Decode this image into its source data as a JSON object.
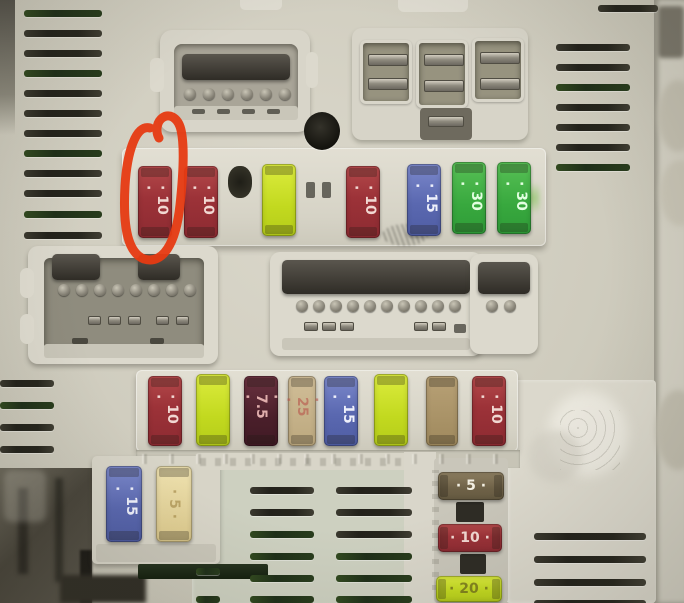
{
  "image": {
    "type": "photograph",
    "subject": "Car engine-bay fuse box (body control module) with mini blade fuses, multi-pin connectors and vent slots",
    "annotation": {
      "kind": "hand-drawn red loop",
      "color": "#e63a12",
      "highlights": "left-most red 10A mini fuse in the upper fuse row"
    }
  },
  "fuses": {
    "top_row": [
      {
        "amps": "10",
        "color": "red",
        "circled": true
      },
      {
        "amps": "10",
        "color": "red"
      },
      {
        "amps": "",
        "color": "yellow-green"
      },
      {
        "amps": "10",
        "color": "red"
      },
      {
        "amps": "15",
        "color": "blue"
      },
      {
        "amps": "30",
        "color": "green"
      },
      {
        "amps": "30",
        "color": "green"
      }
    ],
    "middle_row": [
      {
        "amps": "10",
        "color": "red"
      },
      {
        "amps": "",
        "color": "yellow-green"
      },
      {
        "amps": "7.5",
        "color": "maroon-brown"
      },
      {
        "amps": "25",
        "color": "tan"
      },
      {
        "amps": "15",
        "color": "blue"
      },
      {
        "amps": "",
        "color": "yellow-green"
      },
      {
        "amps": "",
        "color": "tan-brown"
      },
      {
        "amps": "10",
        "color": "red"
      }
    ],
    "bottom_left_pair": [
      {
        "amps": "15",
        "color": "blue"
      },
      {
        "amps": "5",
        "color": "pale-tan"
      }
    ],
    "bottom_right_stack": [
      {
        "amps": "5",
        "color": "dark-tan"
      },
      {
        "amps": "10",
        "color": "red"
      },
      {
        "amps": "20",
        "color": "yellow-green"
      }
    ]
  },
  "palette": {
    "cover_plastic": "#cfccbe",
    "white_strip": "#dedbcf",
    "vent_slot": "#26251d",
    "annotation_red": "#e63a12",
    "fuse_red": "#9c3238",
    "fuse_yellow": "#c2d91f",
    "fuse_blue": "#5a68b0",
    "fuse_green": "#38a83e",
    "fuse_maroon": "#4a1f2a",
    "fuse_tan": "#bca87e",
    "fuse_dark_tan": "#6e6147"
  }
}
